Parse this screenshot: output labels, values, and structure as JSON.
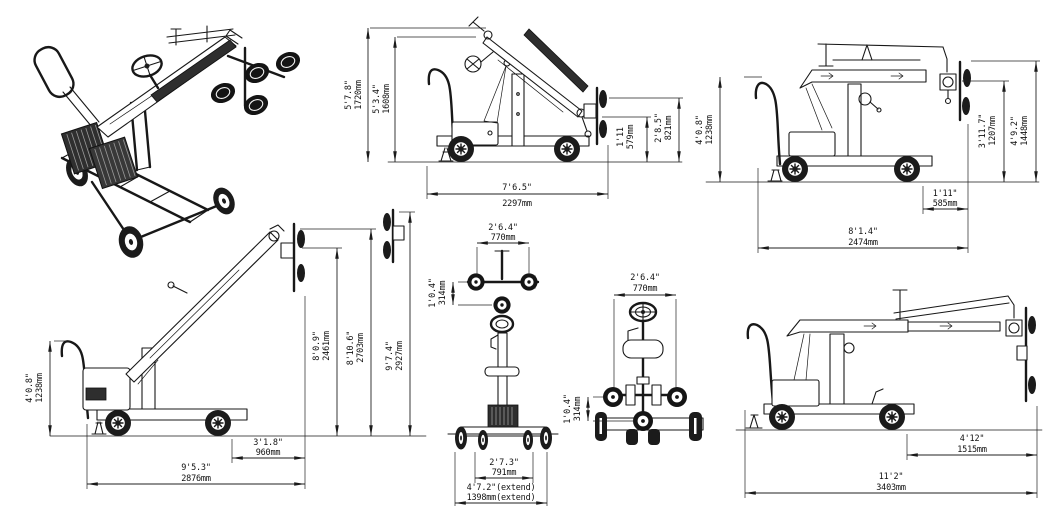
{
  "drawing": {
    "background": "#ffffff",
    "ink": "#1a1a1a",
    "views": {
      "side_mid": {
        "overall_height": {
          "ft": "5'7.8\"",
          "mm": "1720mm"
        },
        "boom_height": {
          "ft": "5'3.4\"",
          "mm": "1608mm"
        },
        "pad_low": {
          "ft": "1'11",
          "mm": "579mm"
        },
        "pad_high": {
          "ft": "2'8.5\"",
          "mm": "821mm"
        },
        "overall_length": {
          "ft": "7'6.5\"",
          "mm": "2297mm"
        }
      },
      "side_horiz": {
        "handle_height": {
          "ft": "4'0.8\"",
          "mm": "1238mm"
        },
        "pad_center_height": {
          "ft": "3'11.7\"",
          "mm": "1207mm"
        },
        "overall_height": {
          "ft": "4'9.2\"",
          "mm": "1448mm"
        },
        "rear_overhang": {
          "ft": "1'11\"",
          "mm": "585mm"
        },
        "overall_length": {
          "ft": "8'1.4\"",
          "mm": "2474mm"
        }
      },
      "side_high": {
        "handle_height": {
          "ft": "4'0.8\"",
          "mm": "1238mm"
        },
        "pad_center_height": {
          "ft": "8'0.9\"",
          "mm": "2461mm"
        },
        "pad_top_height": {
          "ft": "8'10.6\"",
          "mm": "2703mm"
        },
        "max_height": {
          "ft": "9'7.4\"",
          "mm": "2927mm"
        },
        "rear_overhang": {
          "ft": "3'1.8\"",
          "mm": "960mm"
        },
        "overall_length": {
          "ft": "9'5.3\"",
          "mm": "2876mm"
        }
      },
      "front": {
        "pad_width": {
          "ft": "2'6.4\"",
          "mm": "770mm"
        },
        "pad_pitch": {
          "ft": "1'0.4\"",
          "mm": "314mm"
        },
        "track": {
          "ft": "2'7.3\"",
          "mm": "791mm"
        },
        "track_extend": {
          "ft": "4'7.2\"(extend)",
          "mm": "1398mm(extend)"
        }
      },
      "rear": {
        "pad_width": {
          "ft": "2'6.4\"",
          "mm": "770mm"
        },
        "pad_pitch": {
          "ft": "1'0.4\"",
          "mm": "314mm"
        }
      },
      "side_ext": {
        "reach": {
          "ft": "4'12\"",
          "mm": "1515mm"
        },
        "overall_length": {
          "ft": "11'2\"",
          "mm": "3403mm"
        }
      }
    }
  }
}
